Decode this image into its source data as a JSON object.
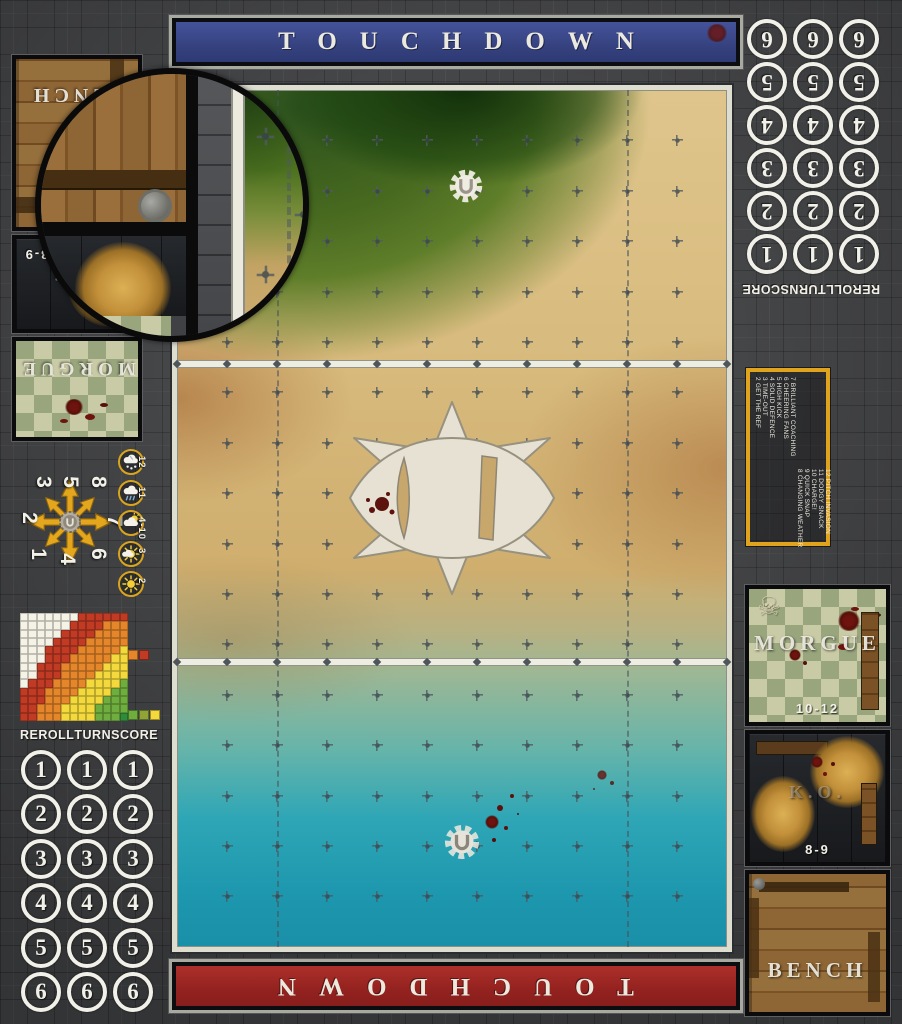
{
  "banners": {
    "top": "TOUCHDOWN",
    "bottom": "TOUCHDOWN"
  },
  "dugout": {
    "bench_label": "BENCH",
    "ko_label": "K.O.",
    "ko_range": "8-9",
    "morgue_label": "MORGUE",
    "morgue_range": "10-12",
    "skull_glyph": "☠"
  },
  "score_track": {
    "column_labels": [
      "REROLL",
      "TURN",
      "SCORE"
    ],
    "row_values": [
      "1",
      "2",
      "3",
      "4",
      "5",
      "6"
    ]
  },
  "scatter_dial": {
    "numbers": [
      "1",
      "2",
      "3",
      "4",
      "5",
      "6",
      "7",
      "8"
    ]
  },
  "weather_track": {
    "entries": [
      {
        "value": "12",
        "icon": "blizzard-cloud-icon"
      },
      {
        "value": "11",
        "icon": "rain-cloud-icon"
      },
      {
        "value": "4-10",
        "icon": "sun-behind-cloud-icon"
      },
      {
        "value": "3",
        "icon": "sun-small-cloud-icon"
      },
      {
        "value": "2",
        "icon": "sun-icon"
      }
    ]
  },
  "kickoff_table": {
    "first_column": [
      "2 GET THE REF",
      "3 TIME-OUT",
      "4 SOLID DEFENCE",
      "5 HIGH KICK",
      "6 CHEERING FANS",
      "7 BRILLIANT COACHING"
    ],
    "second_column": [
      "8 CHANGING WEATHER",
      "9 QUICK SNAP",
      "10 CHARGE!",
      "11 DODGY SNACK",
      "12 PITCH INVASION"
    ]
  },
  "chart_data": {
    "type": "heatmap",
    "title": "pass-range-ruler",
    "grid_rows": [
      "WWWWWWWRRRRRR",
      "WWWWWWRRRROOO",
      "WWWWWRRRROOOO",
      "WWWWRRRROOOOO",
      "WWWRRRROOOOOY",
      "WWWRRROOOOOYY",
      "WWRRROOOOOYYY",
      "WWRRROOOOYYYY",
      "WRRROOOOYYYYG",
      "RRROOOOYYYYGG",
      "RRROOOYYYYGGG",
      "RROOOYYYYGGGG",
      "RROOOYYYYGGGD"
    ],
    "palette": {
      "W": "#f5f2e6",
      "R": "#c03a24",
      "O": "#e5862b",
      "Y": "#f3d93b",
      "G": "#6fae3e",
      "G2": "#8fa437",
      "D": "#2e8b3a"
    },
    "legend_top": [
      "O",
      "R"
    ],
    "legend_bottom": [
      "G",
      "G2",
      "Y"
    ]
  },
  "colors": {
    "banner_blue": "#3a478c",
    "banner_red": "#9c2824",
    "accent_yellow": "#dfa31e",
    "line_white": "#eeede2"
  }
}
